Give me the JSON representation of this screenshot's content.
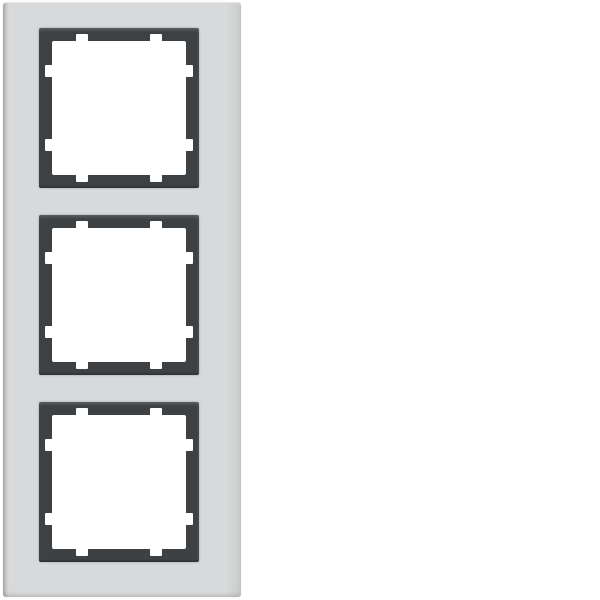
{
  "product": {
    "description": "Vertical 3-gang cover frame, light aluminium plate with three square anthracite module surrounds, each opening notched on all four sides",
    "plate": {
      "left": 3,
      "top": 2,
      "width": 238,
      "height": 595
    },
    "module_size": 160,
    "module_left": 36,
    "module_tops": [
      26,
      213,
      400
    ],
    "opening_inset": 13,
    "notch": {
      "length": 12,
      "depth": 8,
      "positions_pct": [
        22.5,
        77.5
      ]
    }
  },
  "colors": {
    "background": "#ffffff",
    "plate": "#d8d9da",
    "plate_edge_dark": "#b7b9ba",
    "plate_edge_soft": "#c9cbcc",
    "plate_highlight": "#eaebec",
    "inner_frame": "#3e4143",
    "opening": "#ffffff"
  }
}
